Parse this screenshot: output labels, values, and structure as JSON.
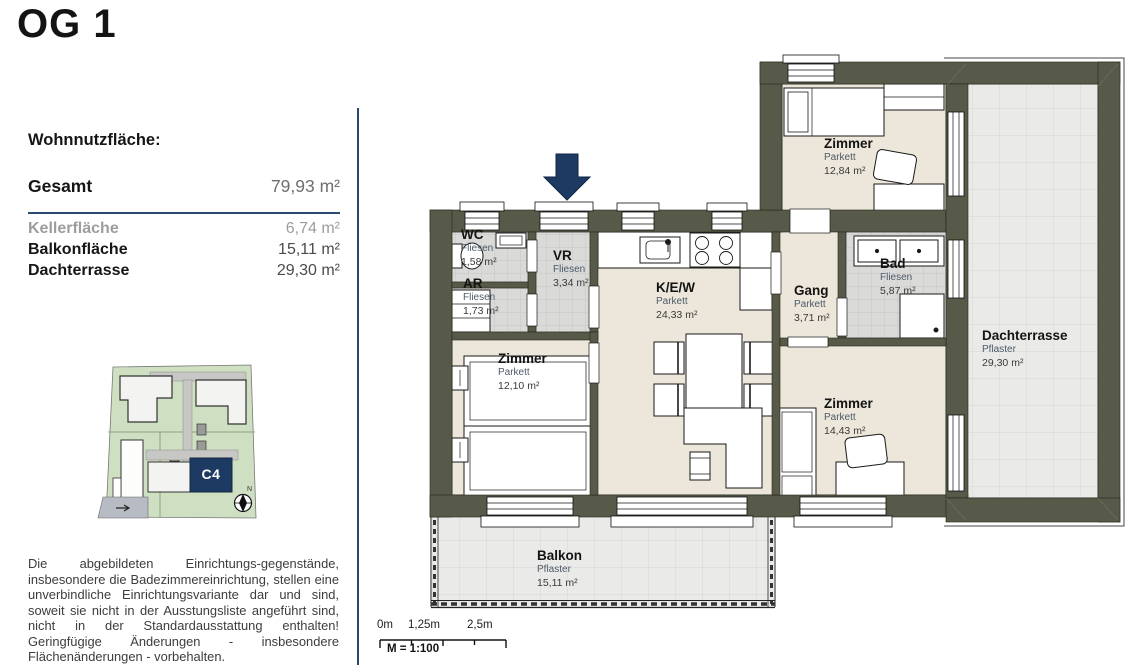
{
  "page": {
    "title": "OG 1"
  },
  "summary": {
    "heading": "Wohnnutzfläche:",
    "total": {
      "label": "Gesamt",
      "value": "79,93 m²"
    },
    "rows": [
      {
        "label": "Kellerfläche",
        "value": "6,74 m²"
      },
      {
        "label": "Balkonfläche",
        "value": "15,11 m²"
      },
      {
        "label": "Dachterrasse",
        "value": "29,30 m²"
      }
    ]
  },
  "site_plan": {
    "unit_label": "C4",
    "north_label": "N"
  },
  "floor_plan": {
    "rooms": [
      {
        "name": "WC",
        "surface": "Fliesen",
        "area": "1,58 m²"
      },
      {
        "name": "VR",
        "surface": "Fliesen",
        "area": "3,34 m²"
      },
      {
        "name": "AR",
        "surface": "Fliesen",
        "area": "1,73 m²"
      },
      {
        "name": "Zimmer",
        "surface": "Parkett",
        "area": "12,10 m²"
      },
      {
        "name": "K/E/W",
        "surface": "Parkett",
        "area": "24,33 m²"
      },
      {
        "name": "Gang",
        "surface": "Parkett",
        "area": "3,71 m²"
      },
      {
        "name": "Bad",
        "surface": "Fliesen",
        "area": "5,87 m²"
      },
      {
        "name": "Zimmer",
        "surface": "Parkett",
        "area": "12,84 m²"
      },
      {
        "name": "Zimmer",
        "surface": "Parkett",
        "area": "14,43 m²"
      },
      {
        "name": "Dachterrasse",
        "surface": "Pflaster",
        "area": "29,30 m²"
      },
      {
        "name": "Balkon",
        "surface": "Pflaster",
        "area": "15,11 m²"
      }
    ]
  },
  "scale_bar": {
    "ticks": [
      "0m",
      "1,25m",
      "2,5m"
    ],
    "scale_label": "M = 1:100"
  },
  "disclaimer": "Die abgebildeten Einrichtungs-gegenstände, insbesondere die Badezimmereinrichtung, stellen eine unverbindliche Einrichtungsvariante dar und sind, soweit sie nicht in der Ausstungsliste angeführt sind, nicht in der Standardausstattung enthalten! Geringfügige Änderungen - insbesondere Flächenänderungen - vorbehalten.",
  "colors": {
    "accent_navy": "#1d3a63",
    "wall_olive": "#575a48",
    "floor_beige": "#ece7da",
    "tile_gray": "#dadad8",
    "paving_gray": "#eaeae8",
    "site_green": "#cfe0c2"
  }
}
